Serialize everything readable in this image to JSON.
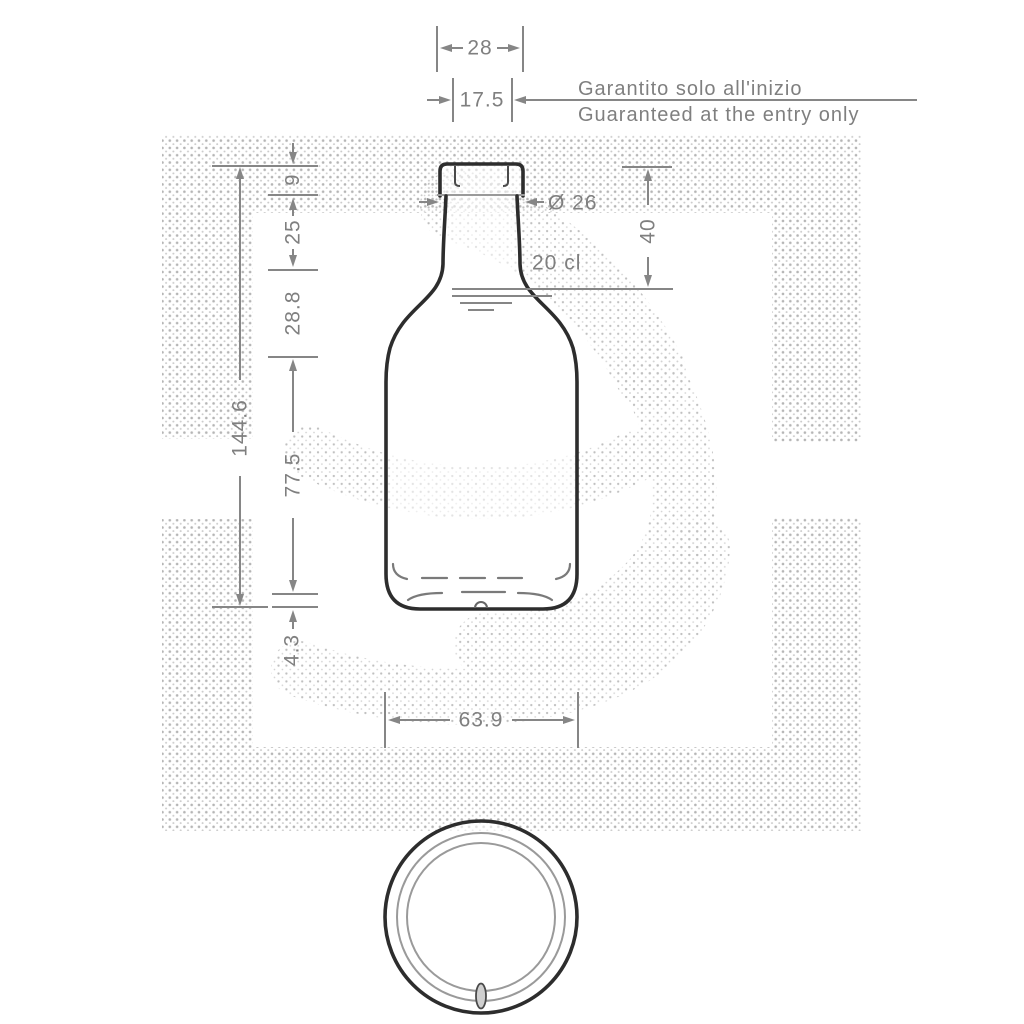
{
  "captions": {
    "it": "Garantito solo all'inizio",
    "en": "Guaranteed at the entry only"
  },
  "labels": {
    "capacity": "20 cl",
    "neck_outer_diameter": "Ø 26"
  },
  "dimensions_mm": {
    "finish_width": "28",
    "bore": "17.5",
    "lip_height": "9",
    "neck_height": "25",
    "shoulder_height": "28.8",
    "total_height": "144.6",
    "body_height": "77.5",
    "base_height": "4.3",
    "fill_depth": "40",
    "body_diameter": "63.9"
  },
  "colors": {
    "outline": "#2d2d2d",
    "dimension_gray": "#868686",
    "halftone_dot": "#b5b5b5"
  }
}
